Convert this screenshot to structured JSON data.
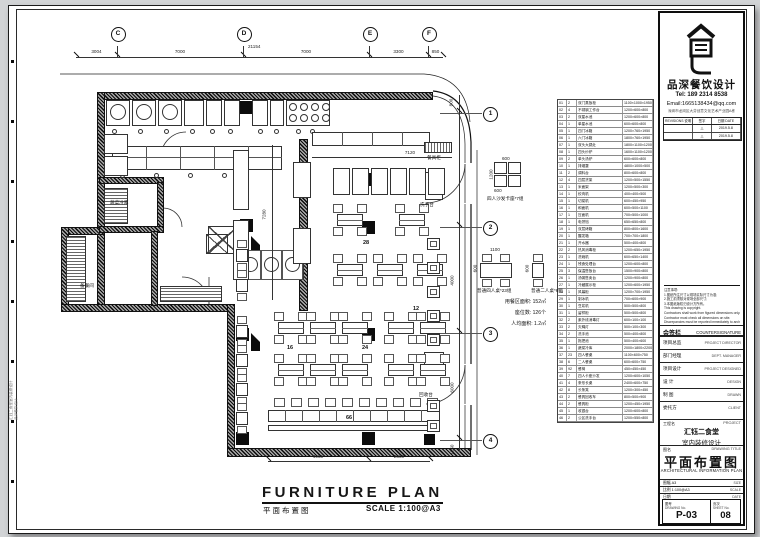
{
  "top_grid": {
    "bubbles": [
      "C",
      "D",
      "E",
      "F"
    ],
    "dims": [
      "3004",
      "7000",
      "7000",
      "3300",
      "850"
    ],
    "total": "21154"
  },
  "right_grid": {
    "bubbles": [
      "1",
      "2",
      "3",
      "4"
    ],
    "dims": [
      "800",
      "4000",
      "6000",
      "1150"
    ]
  },
  "bottom_dims": [
    "4955",
    "2600"
  ],
  "inner_dims": {
    "h": "7120",
    "v": "7280"
  },
  "plan": {
    "labels": {
      "cold_room": "蔬菜冷库",
      "prep_room": "备餐间",
      "cupboard": "餐具柜",
      "wash_counter": "洗手台",
      "return_counter": "回收台"
    },
    "counts": {
      "booth_zone": "28",
      "counter_seats": "12",
      "center_zone": "24",
      "left_zone": "16",
      "bench_zone": "66"
    },
    "stats": [
      "用餐区面积: 152㎡",
      "座位数: 126个",
      "人均面积: 1.2㎡"
    ],
    "legend": {
      "booth": {
        "label": "四人沙发卡座*7组",
        "dim_top": "600",
        "dim_left": "1200",
        "dim_bottom": "600"
      },
      "table4": {
        "label": "普通四人桌*23组",
        "dim_top": "1100",
        "dim_left": "600"
      },
      "table2": {
        "label": "普通二人桌*6组",
        "dim_left": "600",
        "dim_bottom": "600"
      }
    },
    "title": {
      "en": "FURNITURE PLAN",
      "zh": "平面布置图",
      "scale": "SCALE 1:100@A3"
    }
  },
  "schedule": {
    "rows": [
      [
        "01",
        "2",
        "双门蒸饭柜",
        "1100×1000×1950"
      ],
      [
        "02",
        "4",
        "不锈钢工作台",
        "1200×600×800"
      ],
      [
        "03",
        "2",
        "双星水池",
        "1200×600×800"
      ],
      [
        "04",
        "1",
        "单星水池",
        "600×600×800"
      ],
      [
        "05",
        "1",
        "四门冰箱",
        "1200×760×1950"
      ],
      [
        "06",
        "1",
        "六门冰箱",
        "1800×760×1950"
      ],
      [
        "07",
        "1",
        "双头大锅灶",
        "1800×1100×1200"
      ],
      [
        "08",
        "1",
        "四头炒炉",
        "1600×1100×1200"
      ],
      [
        "09",
        "2",
        "单头汤炉",
        "600×600×800"
      ],
      [
        "10",
        "1",
        "排烟罩",
        "4800×1000×500"
      ],
      [
        "11",
        "2",
        "调料台",
        "800×600×800"
      ],
      [
        "12",
        "4",
        "四层货架",
        "1200×500×1550"
      ],
      [
        "13",
        "1",
        "米面架",
        "1200×500×300"
      ],
      [
        "14",
        "1",
        "绞肉机",
        "400×400×500"
      ],
      [
        "15",
        "1",
        "切菜机",
        "600×450×950"
      ],
      [
        "16",
        "1",
        "和面机",
        "600×500×1100"
      ],
      [
        "17",
        "1",
        "压面机",
        "700×500×1000"
      ],
      [
        "18",
        "1",
        "电饼铛",
        "650×650×800"
      ],
      [
        "19",
        "1",
        "双层烤箱",
        "800×800×1600"
      ],
      [
        "20",
        "1",
        "醒发箱",
        "700×700×1800"
      ],
      [
        "21",
        "1",
        "开水器",
        "500×400×800"
      ],
      [
        "22",
        "2",
        "热风消毒柜",
        "1200×650×1950"
      ],
      [
        "23",
        "1",
        "洗碗机",
        "600×650×1400"
      ],
      [
        "24",
        "1",
        "残食处理台",
        "1200×600×800"
      ],
      [
        "25",
        "3",
        "保温售饭台",
        "1500×900×800"
      ],
      [
        "26",
        "1",
        "汤粥售卖台",
        "1200×900×800"
      ],
      [
        "27",
        "1",
        "冷藏展示柜",
        "1200×600×1950"
      ],
      [
        "28",
        "1",
        "风幕柜",
        "1200×700×1950"
      ],
      [
        "29",
        "1",
        "制冰机",
        "700×600×900"
      ],
      [
        "30",
        "1",
        "豆浆机",
        "500×500×800"
      ],
      [
        "31",
        "1",
        "留样柜",
        "500×500×800"
      ],
      [
        "32",
        "2",
        "紫外线消毒灯",
        "600×100×100"
      ],
      [
        "33",
        "2",
        "灭蝇灯",
        "500×100×300"
      ],
      [
        "34",
        "2",
        "洗手池",
        "500×400×800"
      ],
      [
        "35",
        "1",
        "拖把池",
        "500×400×600"
      ],
      [
        "36",
        "1",
        "蔬菜冷库",
        "2000×1800×2200"
      ],
      [
        "37",
        "23",
        "四人餐桌",
        "1100×600×750"
      ],
      [
        "38",
        "6",
        "二人餐桌",
        "600×600×750"
      ],
      [
        "39",
        "92",
        "餐椅",
        "450×450×450"
      ],
      [
        "40",
        "7",
        "四人卡座沙发",
        "1200×600×1050"
      ],
      [
        "41",
        "4",
        "条形长桌",
        "2400×600×750"
      ],
      [
        "42",
        "8",
        "长条凳",
        "1200×300×450"
      ],
      [
        "43",
        "2",
        "餐具回收车",
        "800×500×900"
      ],
      [
        "44",
        "2",
        "餐具柜",
        "1200×450×1950"
      ],
      [
        "45",
        "1",
        "收银台",
        "1200×600×800"
      ],
      [
        "46",
        "2",
        "公区洗手台",
        "1200×550×800"
      ]
    ]
  },
  "titleblock": {
    "company": "品深餐饮设计",
    "tel": "Tel: 189 2314 8538",
    "email": "Email:1665138434@qq.com",
    "address": "深圳市龙岗区大芬创意文化艺术产业园A栋",
    "revisions": {
      "header": [
        "REVISIONS 说明",
        "签字",
        "日期 DATE"
      ],
      "rows": [
        {
          "mark": "△",
          "date": "2019.5.8"
        },
        {
          "mark": "△",
          "date": "2019.5.8"
        }
      ]
    },
    "notes": [
      "注意事项:",
      "1.图纸所注尺寸以现场实际尺寸为准;",
      "2.施工前须核对现场全部尺寸;",
      "3.本图纸版权归设计方所有。",
      "This drawing is copyright.",
      "Contractors shall work from figured dimensions only.",
      "Contractor must check all dimensions on site.",
      "Discrepancies must be reported immediately to architects."
    ],
    "countersign": {
      "zh": "会签栏",
      "en": "COUNTERSIGNATURE"
    },
    "sign_rows": [
      {
        "zh": "项目总监",
        "en": "PROJECT DIRECTOR"
      },
      {
        "zh": "部门经理",
        "en": "DEPT. MANAGER"
      },
      {
        "zh": "项目设计",
        "en": "PROJECT DESIGNED"
      },
      {
        "zh": "设  计",
        "en": "DESIGN"
      },
      {
        "zh": "制  图",
        "en": "DRAWN"
      },
      {
        "zh": "委托方",
        "en": "CLIENT"
      }
    ],
    "project": {
      "zh": "工程名",
      "en": "PROJECT",
      "line1": "汇钰二食堂",
      "line2": "室内装修设计"
    },
    "drawing": {
      "zh": "图名",
      "en": "DRAWING TITLE",
      "title": "平面布置图",
      "subtitle": "ARCHITECTURAL INFORMATION PLAN"
    },
    "meta_rows": [
      {
        "left": "图幅  A3",
        "right": "SIZE"
      },
      {
        "left": "比例  1:100@A3",
        "right": "SCALE"
      },
      {
        "left": "日期",
        "right": "DATE"
      }
    ],
    "dwg_no": {
      "zh": "图号",
      "en": "DRAWING No.",
      "value": "P-03"
    },
    "sheet_no": {
      "zh": "页次",
      "en": "SHEET No.",
      "value": "08"
    }
  },
  "side_strip": {
    "text1": "汇钰二食堂室内装修设计",
    "text2": "品深餐饮设计"
  }
}
